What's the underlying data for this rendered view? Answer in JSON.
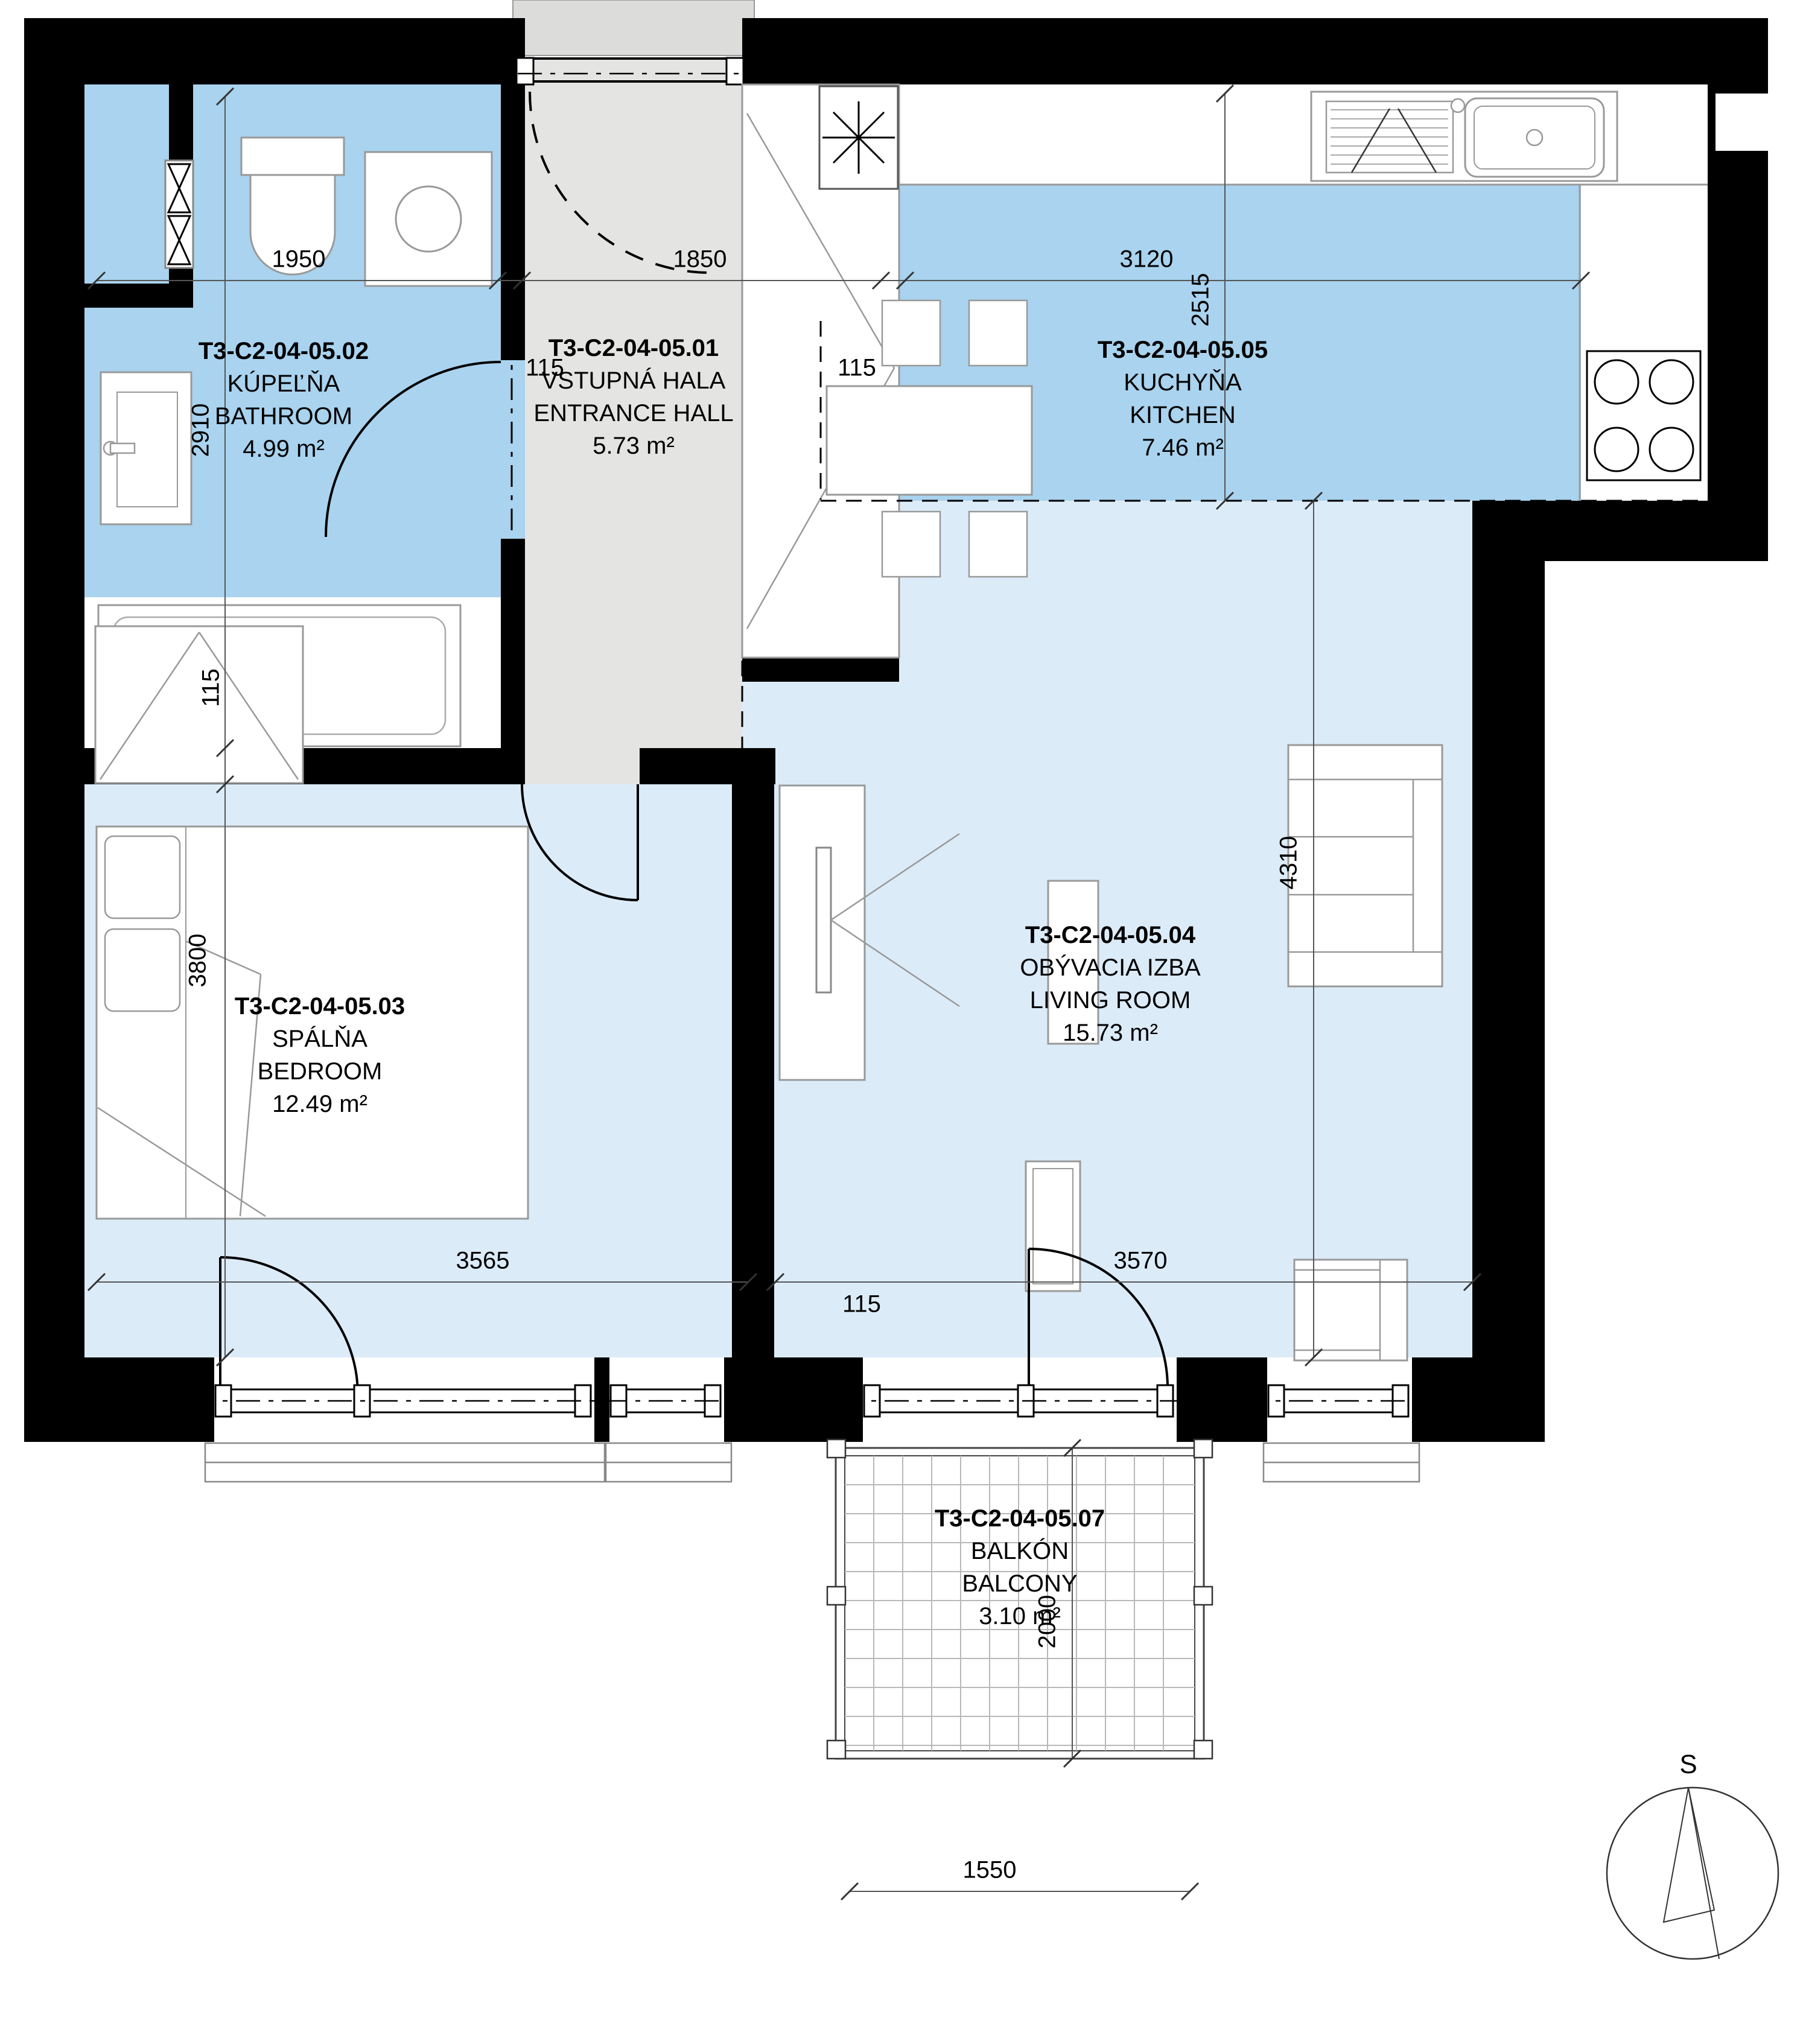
{
  "title": "Apartment floor plan T3-C2-04-05",
  "rooms": [
    {
      "id": "entrance-hall",
      "code": "T3-C2-04-05.01",
      "name_sk": "VSTUPNÁ HALA",
      "name_en": "ENTRANCE HALL",
      "area": "5.73 m²"
    },
    {
      "id": "bathroom",
      "code": "T3-C2-04-05.02",
      "name_sk": "KÚPEĽŇA",
      "name_en": "BATHROOM",
      "area": "4.99 m²"
    },
    {
      "id": "bedroom",
      "code": "T3-C2-04-05.03",
      "name_sk": "SPÁLŇA",
      "name_en": "BEDROOM",
      "area": "12.49 m²"
    },
    {
      "id": "living-room",
      "code": "T3-C2-04-05.04",
      "name_sk": "OBÝVACIA IZBA",
      "name_en": "LIVING ROOM",
      "area": "15.73 m²"
    },
    {
      "id": "kitchen",
      "code": "T3-C2-04-05.05",
      "name_sk": "KUCHYŇA",
      "name_en": "KITCHEN",
      "area": "7.46 m²"
    },
    {
      "id": "balcony",
      "code": "T3-C2-04-05.07",
      "name_sk": "BALKÓN",
      "name_en": "BALCONY",
      "area": "3.10 m²"
    }
  ],
  "dims": [
    {
      "id": "bathroom-width",
      "value": "1950"
    },
    {
      "id": "wall-115-a",
      "value": "115"
    },
    {
      "id": "hall-width",
      "value": "1850"
    },
    {
      "id": "wall-115-b",
      "value": "115"
    },
    {
      "id": "kitchen-width",
      "value": "3120"
    },
    {
      "id": "bathroom-height",
      "value": "2910"
    },
    {
      "id": "wall-115-c",
      "value": "115"
    },
    {
      "id": "bedroom-height",
      "value": "3800"
    },
    {
      "id": "kitchen-depth",
      "value": "2515"
    },
    {
      "id": "living-height",
      "value": "4310"
    },
    {
      "id": "bedroom-width",
      "value": "3565"
    },
    {
      "id": "wall-115-d",
      "value": "115"
    },
    {
      "id": "living-width",
      "value": "3570"
    },
    {
      "id": "balcony-depth",
      "value": "2000"
    },
    {
      "id": "balcony-width",
      "value": "1550"
    }
  ],
  "compass": {
    "label": "S"
  },
  "colors": {
    "wet_room_fill": "#a9d3ee",
    "dry_room_fill": "#dcebf8",
    "hall_fill": "#e4e4e2",
    "wall": "#000000"
  }
}
